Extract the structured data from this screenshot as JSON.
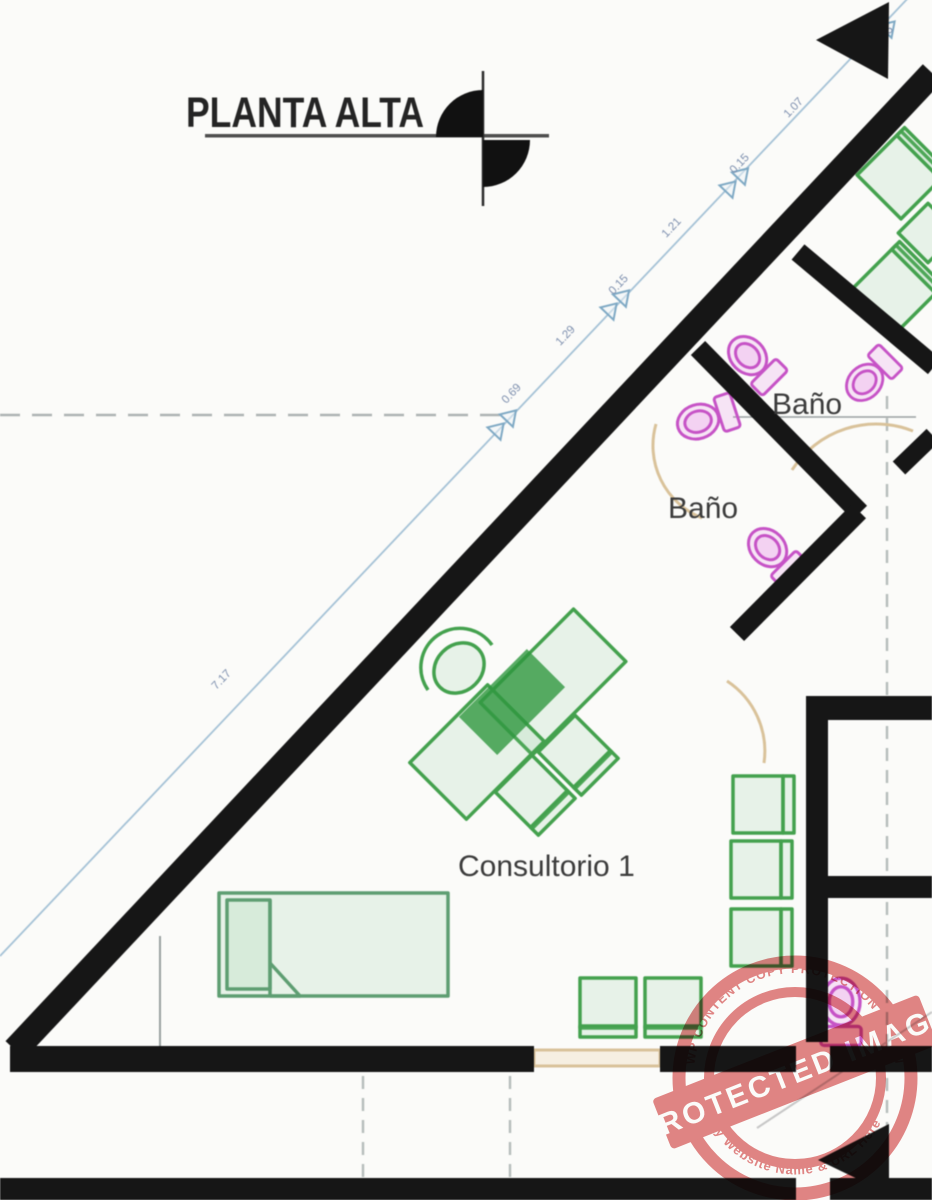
{
  "plan": {
    "title": "PLANTA ALTA",
    "rooms": {
      "bath1": "Baño",
      "bath2": "Baño",
      "consultorio": "Consultorio 1"
    },
    "dims": {
      "seg_long": "7.17",
      "seg_069": "0.69",
      "seg_129": "1.29",
      "seg_015a": "0.15",
      "seg_121": "1.21",
      "seg_015b": "0.15",
      "seg_107": "1.07",
      "seg_125": "1.25"
    }
  },
  "watermark": {
    "arc_top": "WP CONTENT COPY PROTECTION PLUGIN",
    "band": "PROTECTED IMAGE",
    "arc_bottom": "My Website Name & URL Here"
  },
  "colors": {
    "wall": "#161616",
    "furniture_green": "#44a14e",
    "fixture_magenta": "#c653c6",
    "door_tan": "#d9c29a",
    "dimension_blue": "#7fa9c4",
    "stamp_red": "#dd6b6b"
  }
}
